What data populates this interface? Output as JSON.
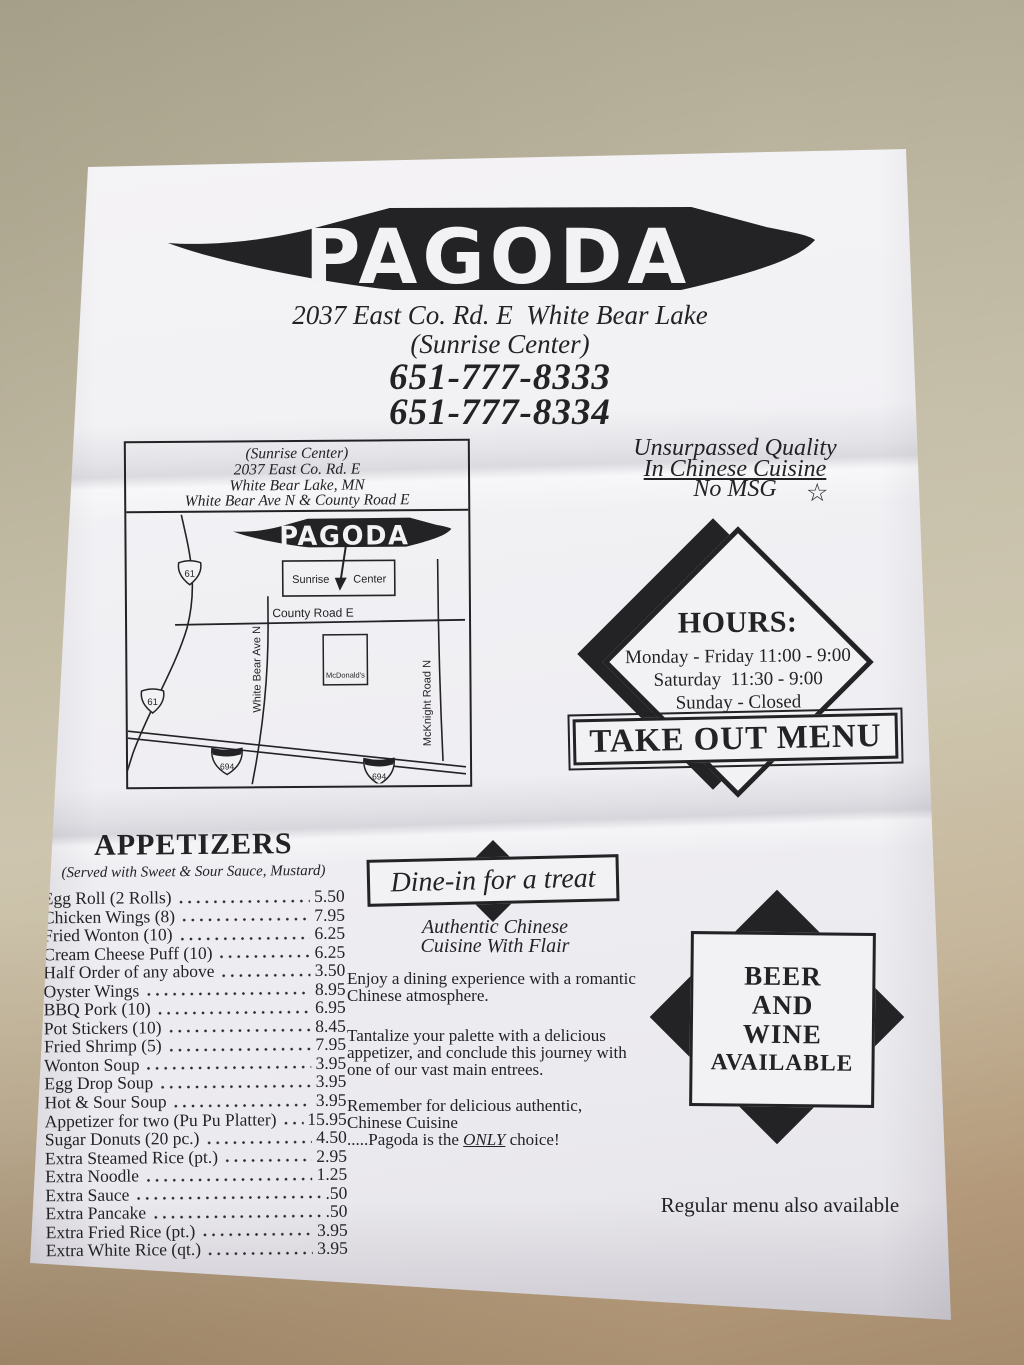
{
  "colors": {
    "background": "#b8b099",
    "paper": "#f2f1f4",
    "ink": "#232326"
  },
  "header": {
    "logo": "PAGODA",
    "address": "2037 East Co. Rd. E  White Bear Lake",
    "suite": "(Sunrise Center)",
    "phone1": "651-777-8333",
    "phone2": "651-777-8334"
  },
  "map": {
    "address_lines": [
      "(Sunrise Center)",
      "2037 East Co. Rd. E",
      "White Bear Lake, MN",
      "White Bear Ave N & County Road E"
    ],
    "logo": "PAGODA",
    "sunrise": "Sunrise",
    "center": "Center",
    "county_road": "County Road E",
    "white_bear_ave": "White Bear Ave N",
    "mcknight_road": "McKnight Road N",
    "mcdonalds": "McDonald's",
    "route_61": "61",
    "route_694": "694"
  },
  "tagline": {
    "line1": "Unsurpassed Quality",
    "line2": "In Chinese Cuisine",
    "line3": "No MSG",
    "star": "☆"
  },
  "hours": {
    "title": "HOURS:",
    "lines": [
      "Monday - Friday 11:00 - 9:00",
      "Saturday  11:30 - 9:00",
      "Sunday - Closed"
    ]
  },
  "takeout_banner": "TAKE OUT MENU",
  "appetizers": {
    "title": "APPETIZERS",
    "subtitle": "(Served with Sweet & Sour Sauce, Mustard)",
    "items": [
      {
        "name": "Egg Roll (2 Rolls)",
        "price": "5.50"
      },
      {
        "name": "Chicken Wings (8)",
        "price": "7.95"
      },
      {
        "name": "Fried Wonton (10)",
        "price": "6.25"
      },
      {
        "name": "Cream Cheese Puff (10)",
        "price": "6.25"
      },
      {
        "name": "Half Order of any above",
        "price": "3.50"
      },
      {
        "name": "Oyster Wings",
        "price": "8.95"
      },
      {
        "name": "BBQ Pork (10)",
        "price": "6.95"
      },
      {
        "name": "Pot Stickers (10)",
        "price": "8.45"
      },
      {
        "name": "Fried Shrimp (5)",
        "price": "7.95"
      },
      {
        "name": "Wonton Soup",
        "price": "3.95"
      },
      {
        "name": "Egg Drop Soup",
        "price": "3.95"
      },
      {
        "name": "Hot & Sour Soup",
        "price": "3.95"
      },
      {
        "name": "Appetizer for two (Pu Pu Platter)",
        "price": "15.95"
      },
      {
        "name": "Sugar Donuts (20 pc.)",
        "price": "4.50"
      },
      {
        "name": "Extra Steamed Rice (pt.)",
        "price": "2.95"
      },
      {
        "name": "Extra Noodle",
        "price": "1.25"
      },
      {
        "name": "Extra Sauce",
        "price": ".50"
      },
      {
        "name": "Extra Pancake",
        "price": ".50"
      },
      {
        "name": "Extra Fried Rice (pt.)",
        "price": "3.95"
      },
      {
        "name": "Extra White Rice (qt.)",
        "price": "3.95"
      }
    ]
  },
  "dinein": {
    "banner": "Dine-in for a treat",
    "tag1": "Authentic Chinese",
    "tag2": "Cuisine With Flair",
    "p1a": "Enjoy a dining experience with a romantic",
    "p1b": "Chinese atmosphere.",
    "p2a": "Tantalize your palette with a delicious",
    "p2b": "appetizer, and conclude this journey with",
    "p2c": "one of our vast main entrees.",
    "p3a": "Remember for delicious authentic,",
    "p3b": "Chinese Cuisine",
    "p3c_pre": ".....Pagoda is the ",
    "p3c_em": "ONLY",
    "p3c_post": " choice!"
  },
  "beer_wine": {
    "lines": [
      "BEER",
      "AND",
      "WINE",
      "AVAILABLE"
    ]
  },
  "footer": "Regular menu also available"
}
